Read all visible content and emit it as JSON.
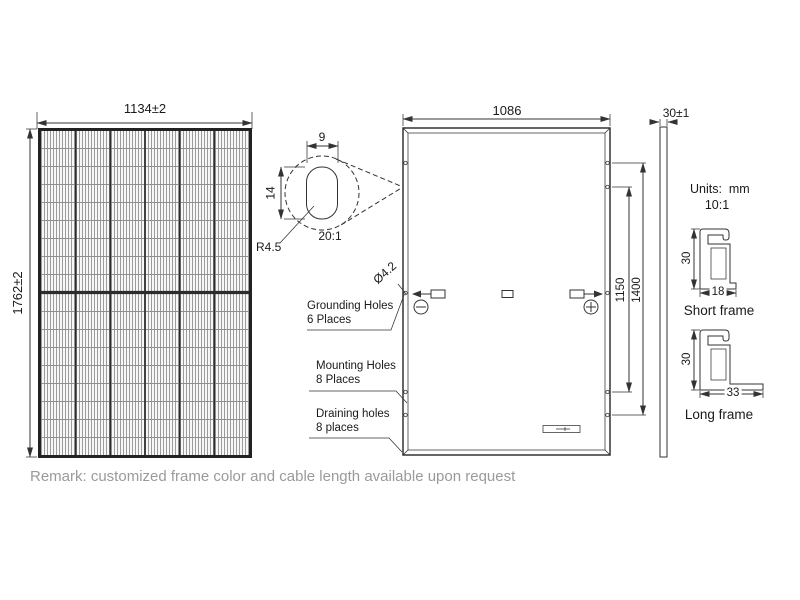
{
  "drawing": {
    "front_view": {
      "width_dim": "1134±2",
      "height_dim": "1762±2",
      "columns": 6,
      "rows": 18
    },
    "detail_view": {
      "slot_width_dim": "9",
      "slot_height_dim": "14",
      "radius_label": "R4.5",
      "scale_label": "20:1"
    },
    "back_view": {
      "width_dim": "1086",
      "hole_dia_label": "Ø4.2",
      "mount_span_inner_dim": "1150",
      "mount_span_outer_dim": "1400",
      "grounding_label_line1": "Grounding Holes",
      "grounding_label_line2": "6 Places",
      "mounting_label_line1": "Mounting Holes",
      "mounting_label_line2": "8 Places",
      "draining_label_line1": "Draining holes",
      "draining_label_line2": "8 places",
      "icons": {
        "negative": "minus-in-circle",
        "positive": "plus-in-circle"
      }
    },
    "side_view": {
      "thickness_dim": "30±1"
    },
    "frame_sections": {
      "units_label": "Units:  mm",
      "scale_label": "10:1",
      "short_frame": {
        "height_dim": "30",
        "width_dim": "18",
        "label": "Short frame"
      },
      "long_frame": {
        "height_dim": "30",
        "width_dim": "33",
        "label": "Long frame"
      }
    },
    "remark": "Remark: customized frame color and cable length available upon request",
    "colors": {
      "line": "#333333",
      "ink": "#1a1a1a",
      "remark": "#9a9a9a"
    }
  }
}
